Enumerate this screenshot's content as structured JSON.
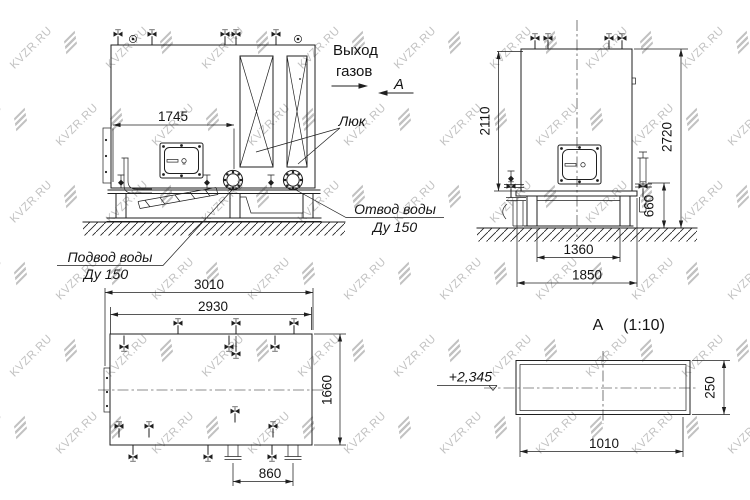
{
  "watermark": {
    "text": "KVZR.RU",
    "color": "#b3b3b3"
  },
  "views": {
    "front": {
      "dims": {
        "d1745": "1745"
      },
      "labels": {
        "gas_out_1": "Выход",
        "gas_out_2": "газов",
        "section_mark": "А",
        "hatch": "Люк",
        "outlet_1": "Отвод воды",
        "outlet_2": "Ду 150",
        "inlet_1": "Подвод воды",
        "inlet_2": "Ду 150"
      }
    },
    "side": {
      "dims": {
        "d2110": "2110",
        "d2720": "2720",
        "d660": "660",
        "d1360": "1360",
        "d1850": "1850"
      }
    },
    "plan": {
      "dims": {
        "d3010": "3010",
        "d2930": "2930",
        "d1660": "1660",
        "d860": "860"
      }
    },
    "section": {
      "title": "А",
      "scale": "(1:10)",
      "elevation": "+2,345",
      "dims": {
        "d1010": "1010",
        "d250": "250"
      }
    }
  }
}
